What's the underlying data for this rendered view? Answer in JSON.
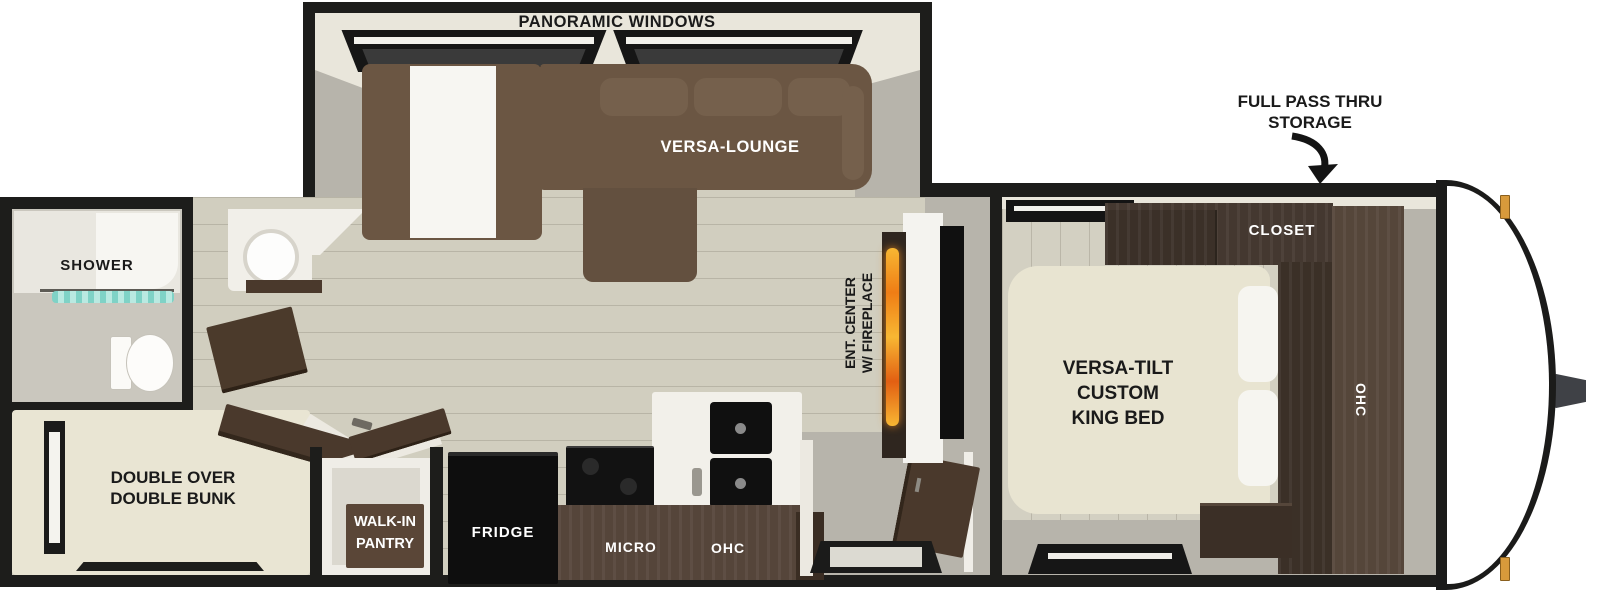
{
  "floorplan": {
    "title": "travel trailer floor plan",
    "labels": {
      "panoramic_windows": "PANORAMIC WINDOWS",
      "versa_lounge": "VERSA-LOUNGE",
      "storage_line1": "FULL PASS THRU",
      "storage_line2": "STORAGE",
      "closet": "CLOSET",
      "bed_line1": "VERSA-TILT",
      "bed_line2": "CUSTOM",
      "bed_line3": "KING BED",
      "bedroom_ohc": "OHC",
      "ent_line1": "ENT. CENTER",
      "ent_line2": "W/ FIREPLACE",
      "shower": "SHOWER",
      "bunk_line1": "DOUBLE OVER",
      "bunk_line2": "DOUBLE BUNK",
      "pantry_line1": "WALK-IN",
      "pantry_line2": "PANTRY",
      "fridge": "FRIDGE",
      "micro": "MICRO",
      "kitchen_ohc": "OHC"
    },
    "colors": {
      "wall_black": "#1d1d1b",
      "floor_wood": "#d1cebf",
      "interior_gray": "#b7b4ab",
      "slide_wall_cream": "#e9e6db",
      "sofa_brown": "#6b5643",
      "cabinet_dark_brown": "#443830",
      "counter_brown": "#55453a",
      "mattress_cream": "#e8e4d1",
      "appliance_black": "#101010",
      "shower_curtain_teal": "#7fd2c6",
      "fireplace_flame_orange": "#f08c1e",
      "marker_light_amber": "#d89a3b",
      "front_cap_white": "#ffffff"
    }
  }
}
